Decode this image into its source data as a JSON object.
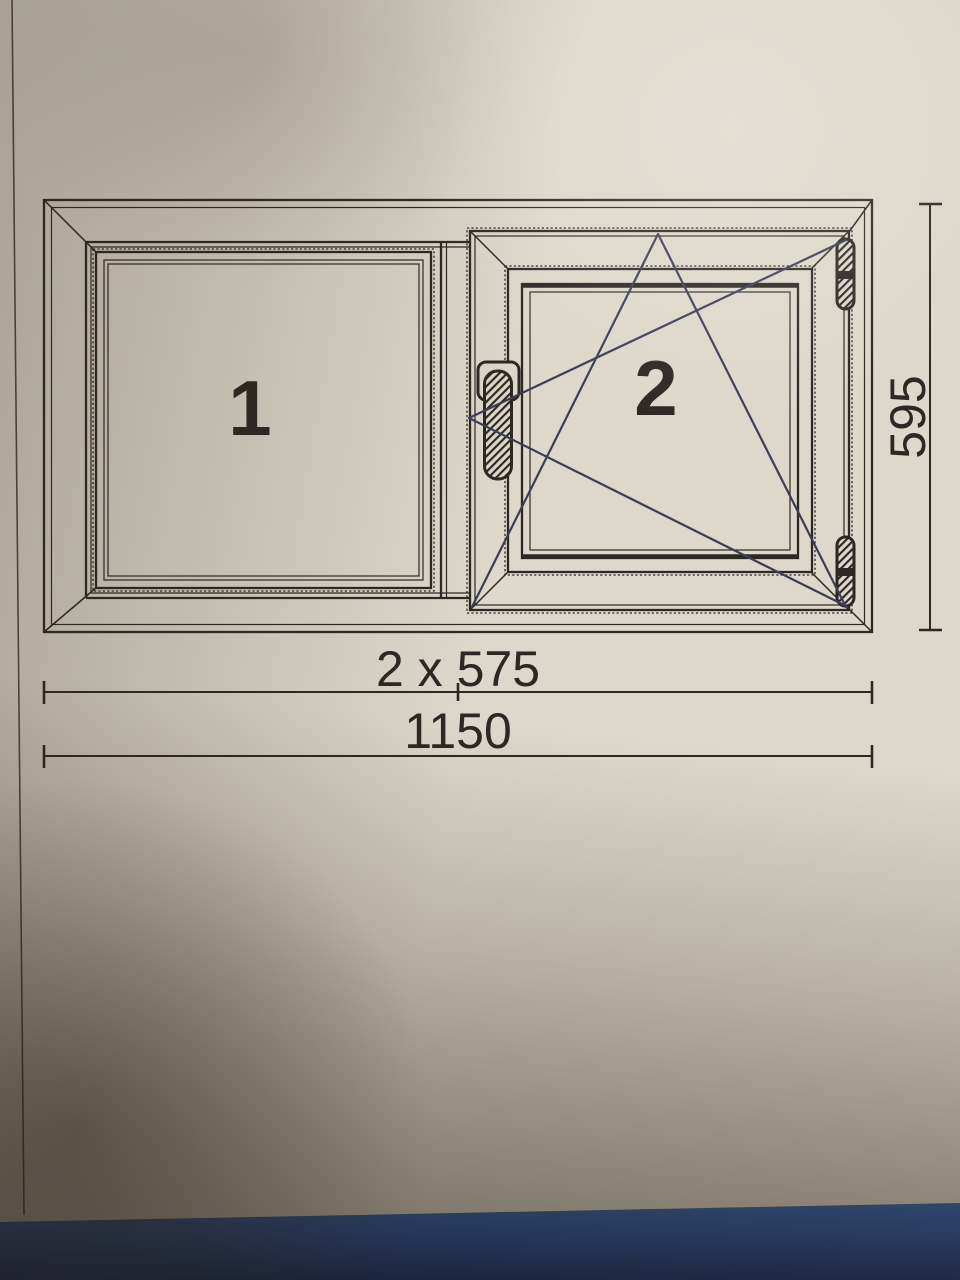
{
  "window_drawing": {
    "pane_labels": {
      "pane1": "1",
      "pane2": "2"
    },
    "dimensions": {
      "width_halves": "2 x 575",
      "width_total": "1150",
      "height": "595"
    },
    "colors": {
      "paper": "#ddd8c9",
      "line": "#2d2823",
      "symbol_line": "#3a3e58",
      "table_blue": "#3568b8",
      "table_blue_dark": "#1e3d7c"
    }
  }
}
